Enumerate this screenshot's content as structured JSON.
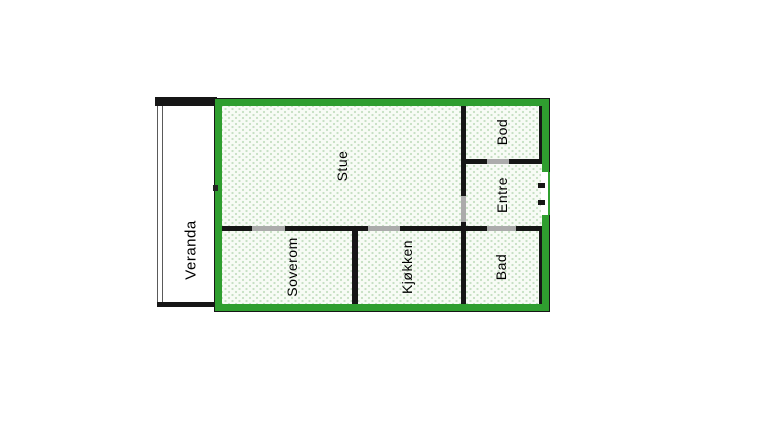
{
  "floorplan": {
    "rooms": [
      {
        "name": "veranda",
        "label": "Veranda"
      },
      {
        "name": "stue",
        "label": "Stue"
      },
      {
        "name": "soverom",
        "label": "Soverom"
      },
      {
        "name": "kjokken",
        "label": "Kjøkken"
      },
      {
        "name": "bod",
        "label": "Bod"
      },
      {
        "name": "entre",
        "label": "Entre"
      },
      {
        "name": "bad",
        "label": "Bad"
      }
    ],
    "colors": {
      "outer_wall_green": "#2f9e2f",
      "interior_wall": "#161616",
      "door_opening": "#ababab",
      "floor_fill": "#f7fbf5",
      "floor_dots": "#c7e0c4",
      "veranda_fill": "#ffffff",
      "background": "#ffffff",
      "label_color": "#000000"
    }
  }
}
